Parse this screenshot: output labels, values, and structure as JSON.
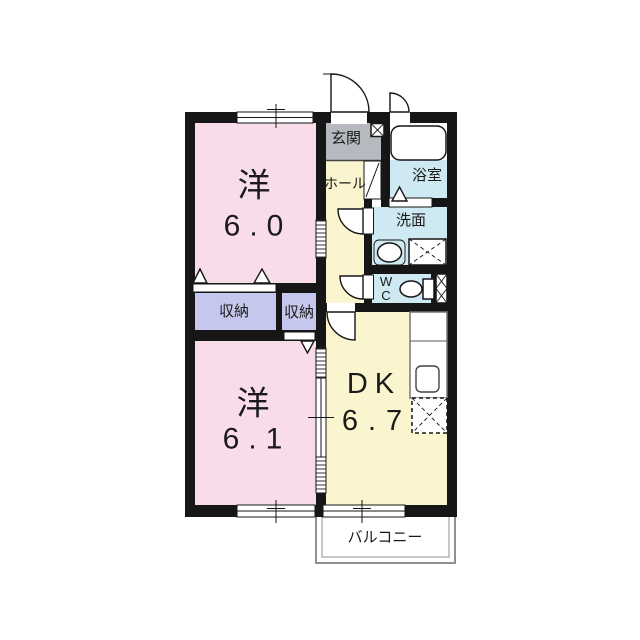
{
  "colors": {
    "wall": "#161616",
    "pink": "#f8dcea",
    "yellow": "#faf4cf",
    "blue": "#cfe9f2",
    "gray": "#b6bac0",
    "purple": "#c6c7ec",
    "balcony": "#909090"
  },
  "rooms": {
    "west1": {
      "name": "洋",
      "area": "6.0"
    },
    "west2": {
      "name": "洋",
      "area": "6.1"
    },
    "dk": {
      "name": "DK",
      "area": "6.7"
    },
    "genkan": {
      "label": "玄関"
    },
    "hall": {
      "label": "ホール"
    },
    "bath": {
      "label": "浴室"
    },
    "washroom": {
      "label": "洗面"
    },
    "wc": {
      "label": "W\nC"
    },
    "closet_a": {
      "label": "収納"
    },
    "closet_b": {
      "label": "収納"
    },
    "balcony": {
      "label": "バルコニー"
    }
  }
}
